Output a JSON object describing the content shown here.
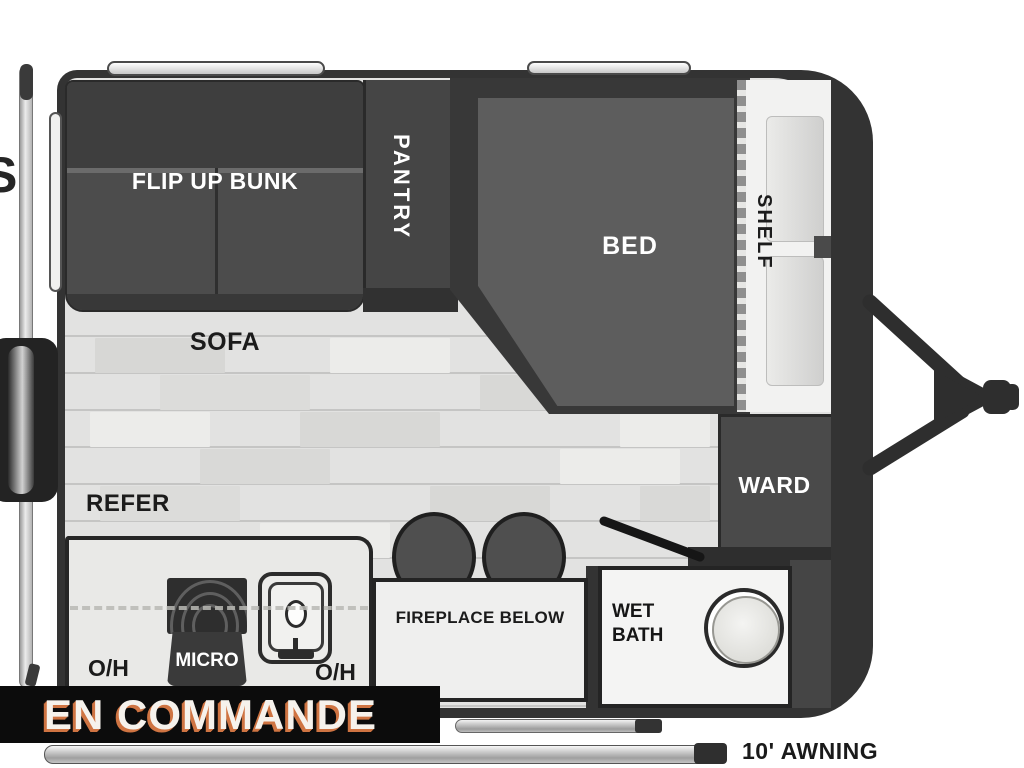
{
  "title": "Travel trailer floor plan",
  "rooms": {
    "flip_up_bunk": "FLIP UP BUNK",
    "pantry": "PANTRY",
    "bed": "BED",
    "shelf": "SHELF",
    "sofa": "SOFA",
    "refer": "REFER",
    "ward": "WARD",
    "micro": "MICRO",
    "oh_left": "O/H",
    "oh_right": "O/H",
    "fireplace": "FIREPLACE BELOW",
    "wet_bath_line1": "WET",
    "wet_bath_line2": "BATH"
  },
  "banner": {
    "text": "EN COMMANDE"
  },
  "awning": {
    "label": "10' AWNING"
  },
  "edge_fragment": "S",
  "colors": {
    "wall": "#333333",
    "floor": "#e2e2e1",
    "dark_furniture": "#4a4a4a",
    "bed": "#5d5d5d",
    "white_room": "#f2f2f1",
    "banner_bg": "#0c0c0c",
    "banner_text": "#f6f2ec",
    "banner_shadow": "#cf7442"
  }
}
